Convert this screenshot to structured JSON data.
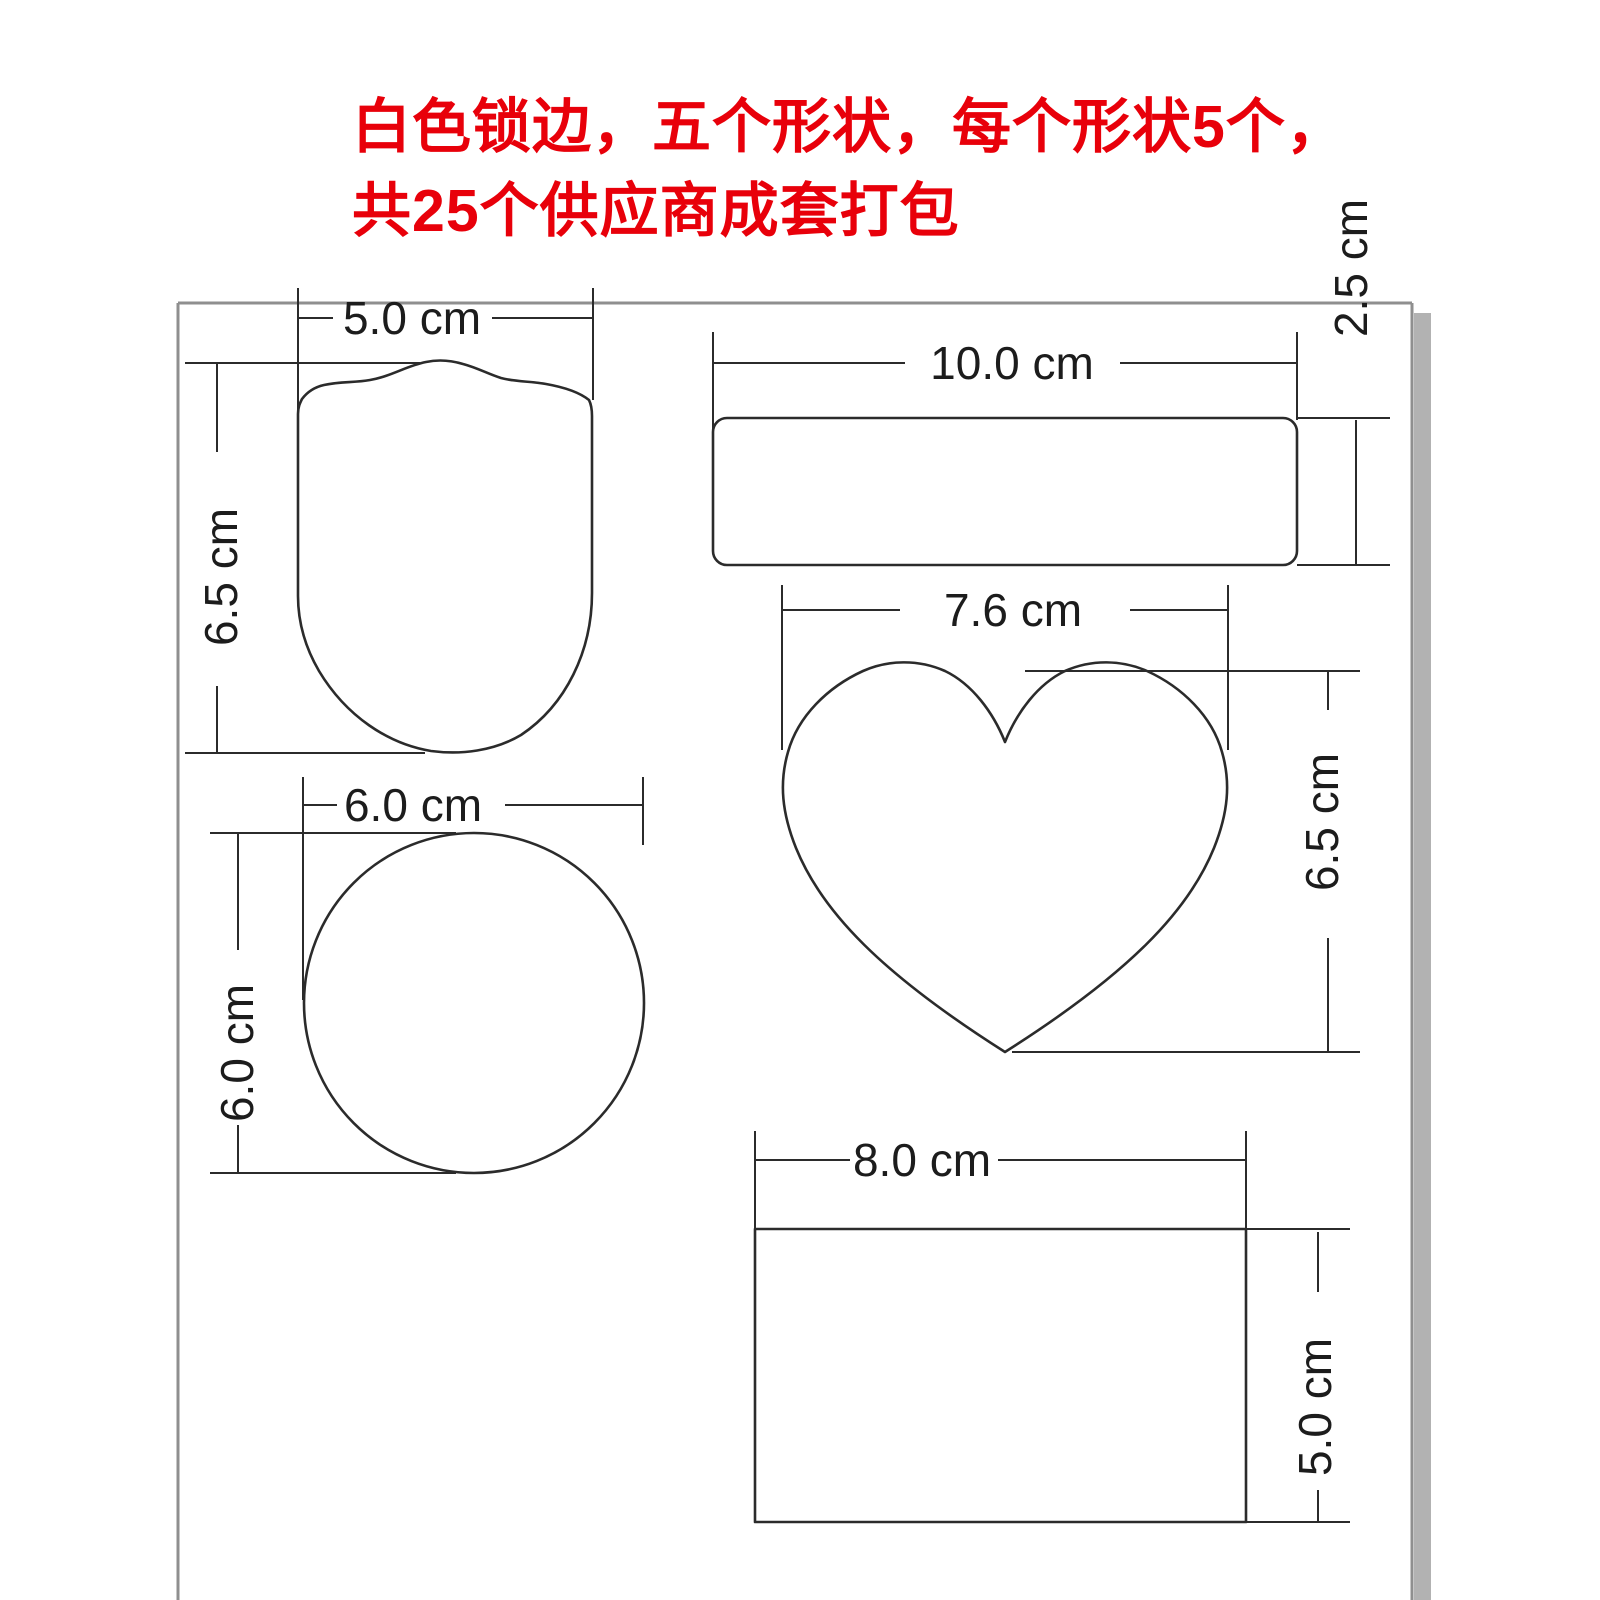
{
  "diagram": {
    "annotation": {
      "line1": "白色锁边，五个形状，每个形状5个，",
      "line2": "共25个供应商成套打包"
    },
    "shapes": {
      "shield": {
        "name": "shield-badge",
        "width_label": "5.0 cm",
        "height_label": "6.5 cm"
      },
      "rounded_rect": {
        "name": "rounded-strip-rectangle",
        "width_label": "10.0 cm",
        "height_label": "2.5 cm"
      },
      "heart": {
        "name": "heart",
        "width_label": "7.6 cm",
        "height_label": "6.5 cm"
      },
      "circle": {
        "name": "circle",
        "width_label": "6.0 cm",
        "height_label": "6.0 cm"
      },
      "rectangle": {
        "name": "rectangle",
        "width_label": "8.0 cm",
        "height_label": "5.0 cm"
      }
    },
    "colors": {
      "annotation_red": "#e8000a",
      "drawing_line": "#2b2b2b",
      "page_border": "#8f8f8f",
      "page_shadow": "#b2b2b2"
    },
    "unit": "cm"
  }
}
